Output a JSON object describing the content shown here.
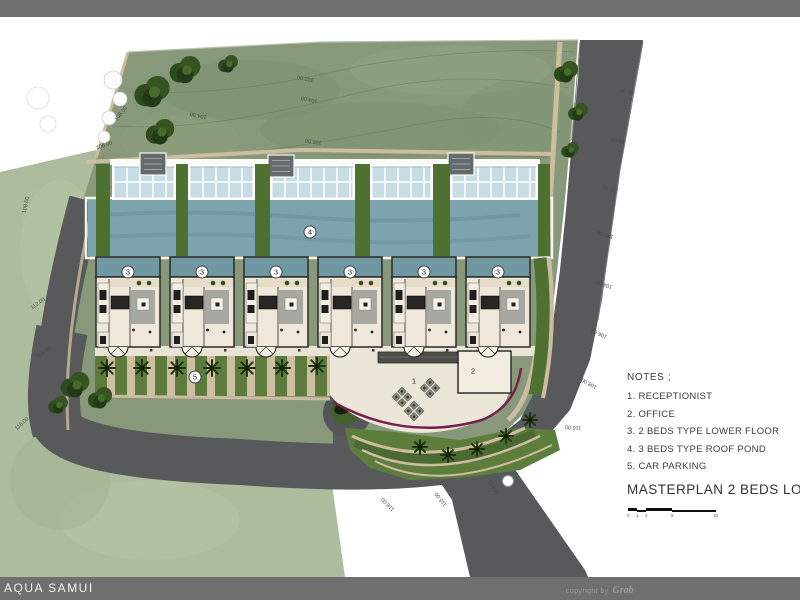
{
  "footer": {
    "project_name": "AQUA SAMUI",
    "copyright_prefix": "copyright by",
    "copyright_logo": "Grab"
  },
  "notes": {
    "heading": "NOTES ;",
    "items": [
      "1. RECEPTIONIST",
      "2. OFFICE",
      "3. 2 BEDS TYPE LOWER FLOOR",
      "4. 3 BEDS TYPE ROOF POND",
      "5. CAR PARKING"
    ]
  },
  "plan_title": "MASTERPLAN 2 BEDS LOWER",
  "scale_bar": {
    "ticks": [
      "0",
      "1",
      "2",
      "5",
      "10"
    ]
  },
  "plan_labels": [
    {
      "text": "3",
      "x": 128,
      "y": 272,
      "circle": true
    },
    {
      "text": "3",
      "x": 202,
      "y": 272,
      "circle": true
    },
    {
      "text": "3",
      "x": 276,
      "y": 272,
      "circle": true
    },
    {
      "text": "3",
      "x": 350,
      "y": 272,
      "circle": true
    },
    {
      "text": "3",
      "x": 424,
      "y": 272,
      "circle": true
    },
    {
      "text": "3",
      "x": 498,
      "y": 272,
      "circle": true
    },
    {
      "text": "4",
      "x": 310,
      "y": 232,
      "circle": true
    },
    {
      "text": "5",
      "x": 195,
      "y": 377,
      "circle": true
    },
    {
      "text": "1",
      "x": 414,
      "y": 381,
      "circle": false
    },
    {
      "text": "2",
      "x": 473,
      "y": 371,
      "circle": false
    }
  ],
  "contour_labels": [
    {
      "text": "96.00",
      "x": 620,
      "y": 88,
      "rot": 190
    },
    {
      "text": "98.00",
      "x": 611,
      "y": 137,
      "rot": 192
    },
    {
      "text": "100.00",
      "x": 602,
      "y": 185,
      "rot": 195
    },
    {
      "text": "102.00",
      "x": 597,
      "y": 231,
      "rot": 197
    },
    {
      "text": "104.00",
      "x": 596,
      "y": 281,
      "rot": 200
    },
    {
      "text": "106.00",
      "x": 591,
      "y": 330,
      "rot": 205
    },
    {
      "text": "108.00",
      "x": 581,
      "y": 380,
      "rot": 210
    },
    {
      "text": "110.00",
      "x": 565,
      "y": 424,
      "rot": 185
    },
    {
      "text": "114.00",
      "x": 486,
      "y": 484,
      "rot": 240
    },
    {
      "text": "116.00",
      "x": 433,
      "y": 496,
      "rot": 232
    },
    {
      "text": "118.00",
      "x": 380,
      "y": 501,
      "rot": 225
    },
    {
      "text": "116.00",
      "x": 14,
      "y": 421,
      "rot": -42
    },
    {
      "text": "114.00",
      "x": 35,
      "y": 350,
      "rot": -28
    },
    {
      "text": "112.00",
      "x": 30,
      "y": 301,
      "rot": -35
    },
    {
      "text": "108.00",
      "x": 18,
      "y": 202,
      "rot": -78
    },
    {
      "text": "106.00",
      "x": 96,
      "y": 143,
      "rot": -18
    },
    {
      "text": "108.00",
      "x": 113,
      "y": 111,
      "rot": -52
    },
    {
      "text": "102.00",
      "x": 297,
      "y": 75,
      "rot": 190
    },
    {
      "text": "104.00",
      "x": 301,
      "y": 96,
      "rot": 193
    },
    {
      "text": "106.00",
      "x": 305,
      "y": 138,
      "rot": 190
    },
    {
      "text": "104.00",
      "x": 190,
      "y": 112,
      "rot": 192
    }
  ],
  "colors": {
    "bar_gray": "#6f6f6f",
    "hill_green": "#87997a",
    "lowland_green": "#aebc9e",
    "road_gray": "#58595b",
    "main_pool": "#7da4ae",
    "villa_pool": "#6f98a2",
    "glass": "#c7dde3",
    "grass_strip": "#4e7030",
    "sand_path": "#cdbda0",
    "plaza_cream": "#ece6d8",
    "maroon_line": "#78214c"
  }
}
